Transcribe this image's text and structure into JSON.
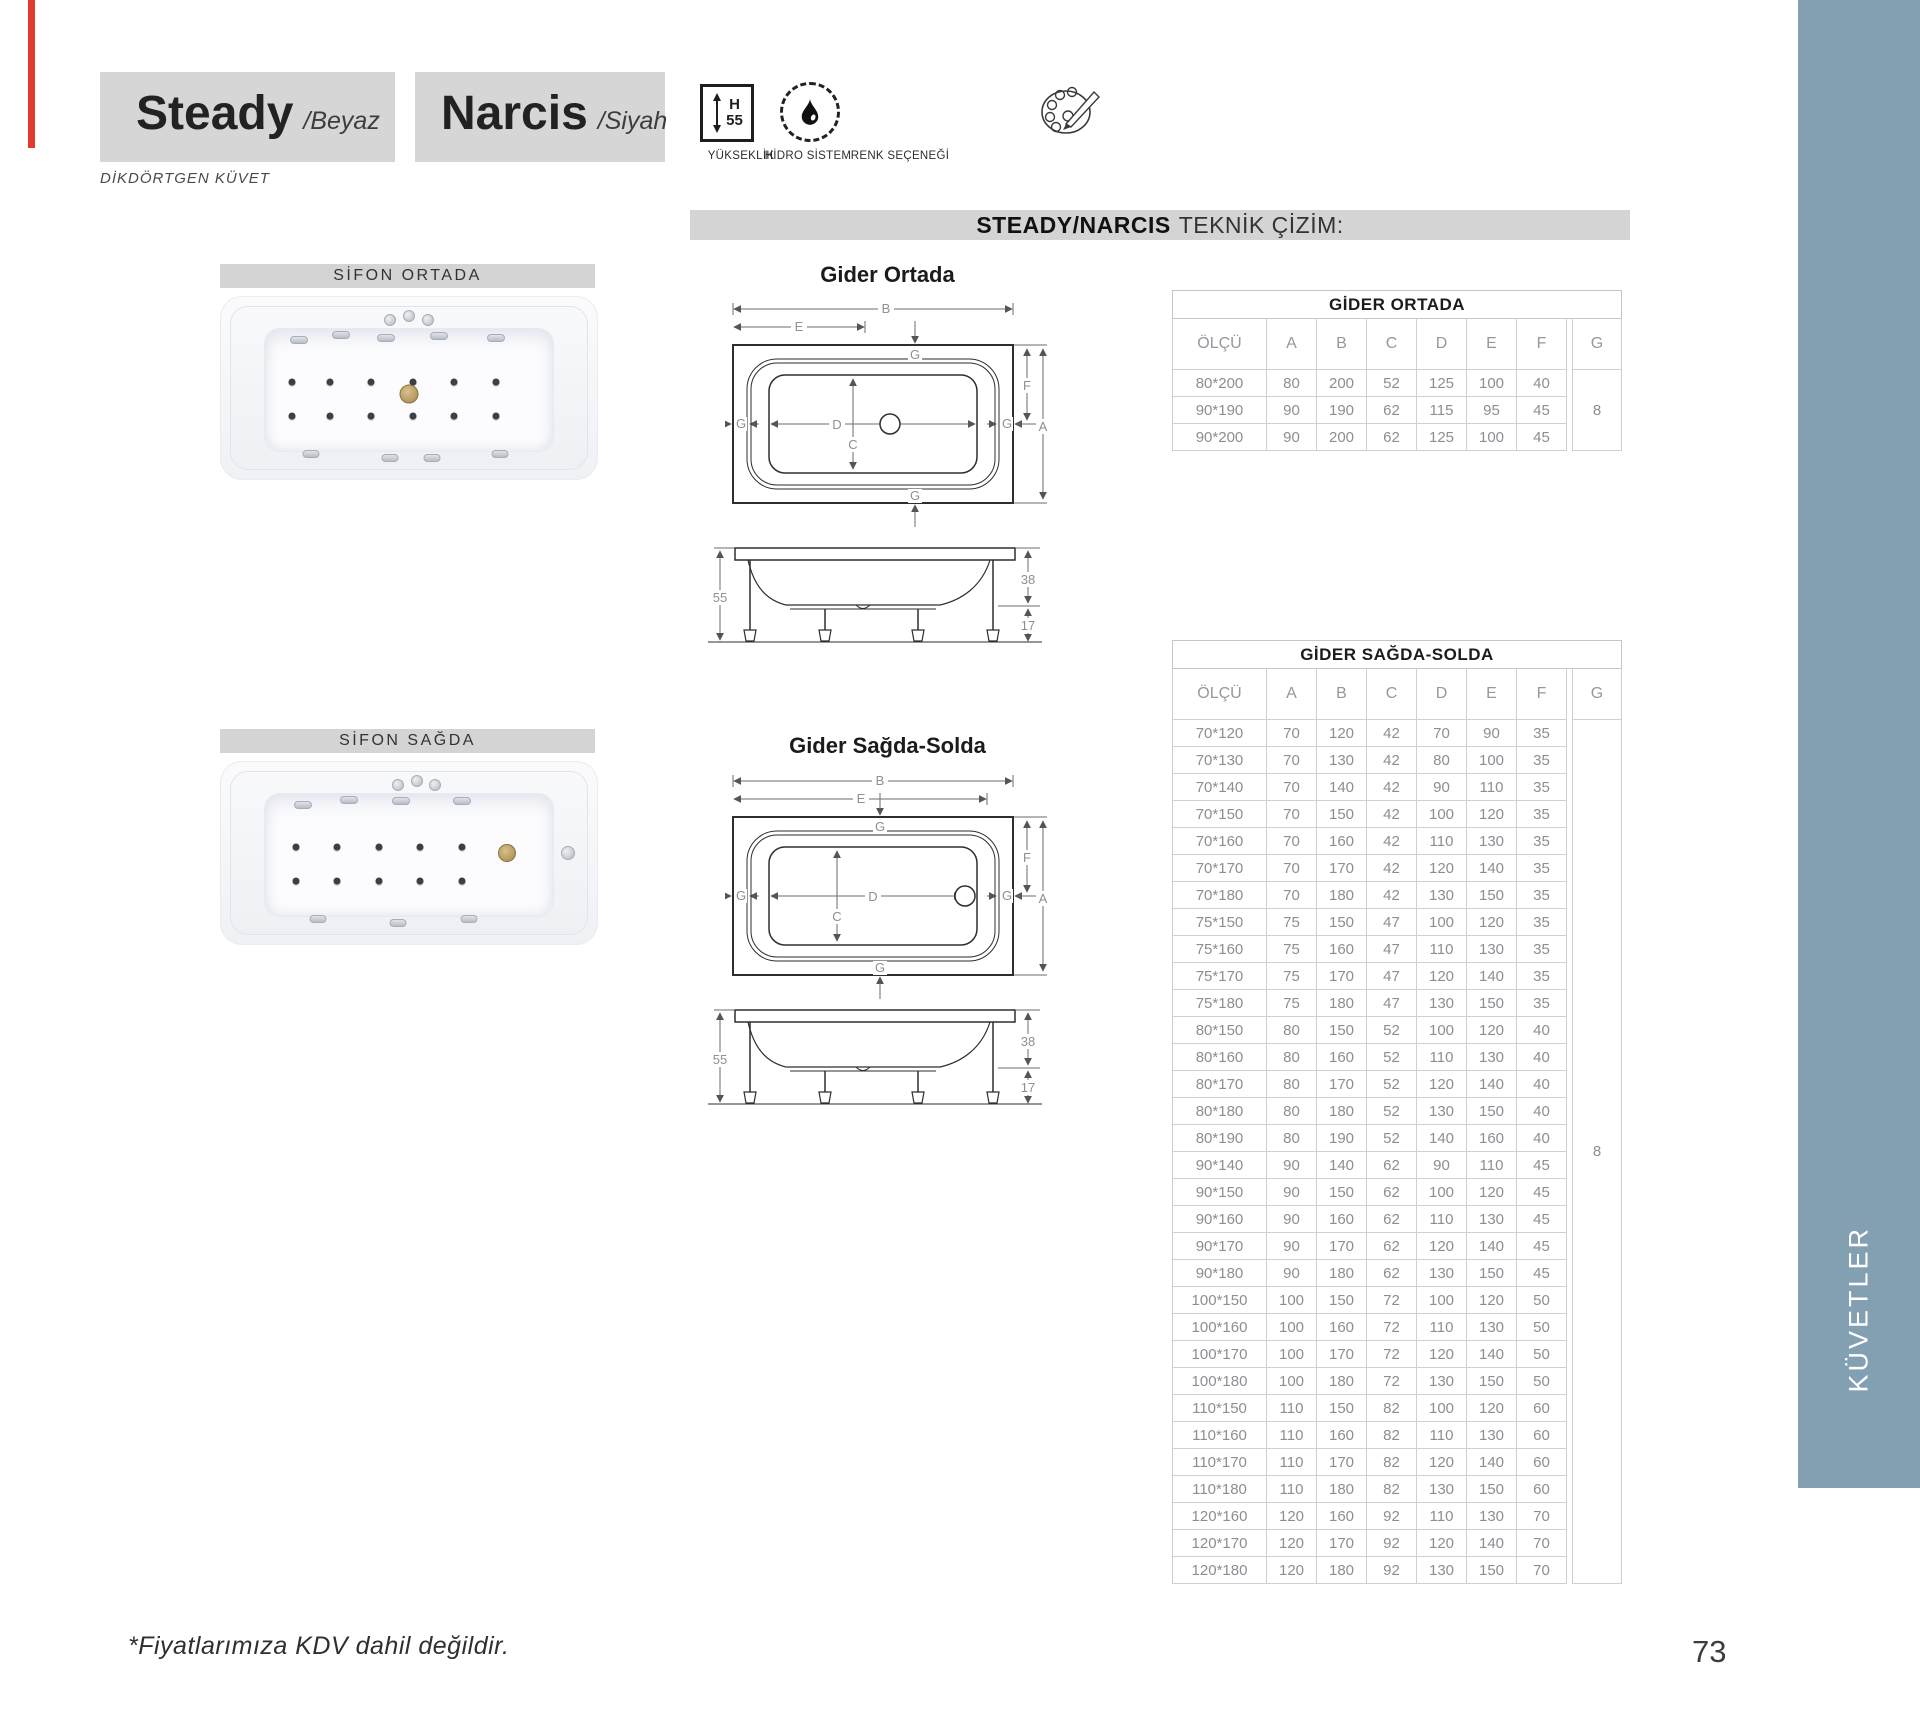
{
  "page": {
    "footnote": "*Fiyatlarımıza KDV dahil değildir.",
    "number": "73"
  },
  "header": {
    "products": [
      {
        "name": "Steady",
        "variant": "/Beyaz"
      },
      {
        "name": "Narcis",
        "variant": "/Siyah"
      }
    ],
    "category": "DİKDÖRTGEN KÜVET",
    "features": {
      "height": {
        "label": "YÜKSEKLİK",
        "h": "H",
        "value": "55"
      },
      "hydro": {
        "label": "HİDRO SİSTEM"
      },
      "color": {
        "label": "RENK SEÇENEĞİ"
      }
    }
  },
  "section": {
    "title_bold": "STEADY/NARCIS",
    "title_rest": "TEKNİK ÇİZİM:"
  },
  "gallery": [
    {
      "label": "SİFON ORTADA"
    },
    {
      "label": "SİFON SAĞDA"
    }
  ],
  "drawings": {
    "plan1_title": "Gider Ortada",
    "plan2_title": "Gider Sağda-Solda",
    "labels": {
      "A": "A",
      "B": "B",
      "C": "C",
      "D": "D",
      "E": "E",
      "F": "F",
      "G": "G"
    },
    "side": {
      "height": "55",
      "depth": "38",
      "leg": "17"
    }
  },
  "sidebar": {
    "label": "KÜVETLER",
    "color": "#83a0b3"
  },
  "tables": [
    {
      "title": "GİDER ORTADA",
      "columns": [
        "ÖLÇÜ",
        "A",
        "B",
        "C",
        "D",
        "E",
        "F",
        "G"
      ],
      "g_value": "8",
      "rows": [
        [
          "80*200",
          "80",
          "200",
          "52",
          "125",
          "100",
          "40"
        ],
        [
          "90*190",
          "90",
          "190",
          "62",
          "115",
          "95",
          "45"
        ],
        [
          "90*200",
          "90",
          "200",
          "62",
          "125",
          "100",
          "45"
        ]
      ]
    },
    {
      "title": "GİDER SAĞDA-SOLDA",
      "columns": [
        "ÖLÇÜ",
        "A",
        "B",
        "C",
        "D",
        "E",
        "F",
        "G"
      ],
      "g_value": "8",
      "rows": [
        [
          "70*120",
          "70",
          "120",
          "42",
          "70",
          "90",
          "35"
        ],
        [
          "70*130",
          "70",
          "130",
          "42",
          "80",
          "100",
          "35"
        ],
        [
          "70*140",
          "70",
          "140",
          "42",
          "90",
          "110",
          "35"
        ],
        [
          "70*150",
          "70",
          "150",
          "42",
          "100",
          "120",
          "35"
        ],
        [
          "70*160",
          "70",
          "160",
          "42",
          "110",
          "130",
          "35"
        ],
        [
          "70*170",
          "70",
          "170",
          "42",
          "120",
          "140",
          "35"
        ],
        [
          "70*180",
          "70",
          "180",
          "42",
          "130",
          "150",
          "35"
        ],
        [
          "75*150",
          "75",
          "150",
          "47",
          "100",
          "120",
          "35"
        ],
        [
          "75*160",
          "75",
          "160",
          "47",
          "110",
          "130",
          "35"
        ],
        [
          "75*170",
          "75",
          "170",
          "47",
          "120",
          "140",
          "35"
        ],
        [
          "75*180",
          "75",
          "180",
          "47",
          "130",
          "150",
          "35"
        ],
        [
          "80*150",
          "80",
          "150",
          "52",
          "100",
          "120",
          "40"
        ],
        [
          "80*160",
          "80",
          "160",
          "52",
          "110",
          "130",
          "40"
        ],
        [
          "80*170",
          "80",
          "170",
          "52",
          "120",
          "140",
          "40"
        ],
        [
          "80*180",
          "80",
          "180",
          "52",
          "130",
          "150",
          "40"
        ],
        [
          "80*190",
          "80",
          "190",
          "52",
          "140",
          "160",
          "40"
        ],
        [
          "90*140",
          "90",
          "140",
          "62",
          "90",
          "110",
          "45"
        ],
        [
          "90*150",
          "90",
          "150",
          "62",
          "100",
          "120",
          "45"
        ],
        [
          "90*160",
          "90",
          "160",
          "62",
          "110",
          "130",
          "45"
        ],
        [
          "90*170",
          "90",
          "170",
          "62",
          "120",
          "140",
          "45"
        ],
        [
          "90*180",
          "90",
          "180",
          "62",
          "130",
          "150",
          "45"
        ],
        [
          "100*150",
          "100",
          "150",
          "72",
          "100",
          "120",
          "50"
        ],
        [
          "100*160",
          "100",
          "160",
          "72",
          "110",
          "130",
          "50"
        ],
        [
          "100*170",
          "100",
          "170",
          "72",
          "120",
          "140",
          "50"
        ],
        [
          "100*180",
          "100",
          "180",
          "72",
          "130",
          "150",
          "50"
        ],
        [
          "110*150",
          "110",
          "150",
          "82",
          "100",
          "120",
          "60"
        ],
        [
          "110*160",
          "110",
          "160",
          "82",
          "110",
          "130",
          "60"
        ],
        [
          "110*170",
          "110",
          "170",
          "82",
          "120",
          "140",
          "60"
        ],
        [
          "110*180",
          "110",
          "180",
          "82",
          "130",
          "150",
          "60"
        ],
        [
          "120*160",
          "120",
          "160",
          "92",
          "110",
          "130",
          "70"
        ],
        [
          "120*170",
          "120",
          "170",
          "92",
          "120",
          "140",
          "70"
        ],
        [
          "120*180",
          "120",
          "180",
          "92",
          "130",
          "150",
          "70"
        ]
      ]
    }
  ]
}
